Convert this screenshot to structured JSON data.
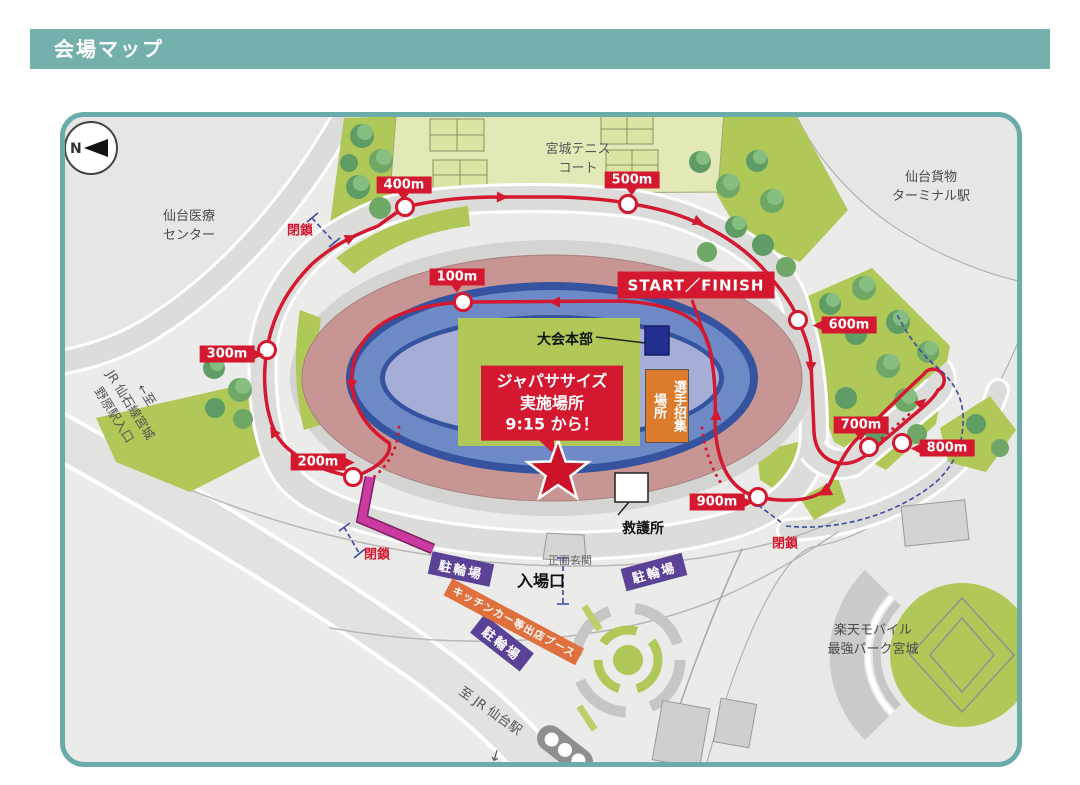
{
  "header": {
    "title": "会場マップ"
  },
  "compass": {
    "label": "N"
  },
  "places": {
    "medical": "仙台医療\nセンター",
    "tennis": "宮城テニス\nコート",
    "freight": "仙台貨物\nターミナル駅",
    "rakuten": "楽天モバイル\n最強パーク宮城",
    "hq": "大会本部",
    "first_aid": "救護所",
    "entrance_gate": "入場口",
    "main_entrance": "正面玄関",
    "assembly": "選手招集\n場所"
  },
  "event_box": {
    "text": "ジャパササイズ\n実施場所\n9:15 から！"
  },
  "course": {
    "start_finish": "START／FINISH",
    "closure_label": "閉鎖",
    "markers": [
      {
        "label": "100m"
      },
      {
        "label": "200m"
      },
      {
        "label": "300m"
      },
      {
        "label": "400m"
      },
      {
        "label": "500m"
      },
      {
        "label": "600m"
      },
      {
        "label": "700m"
      },
      {
        "label": "800m"
      },
      {
        "label": "900m"
      }
    ]
  },
  "banners": {
    "bike": "駐輪場",
    "kitchen": "キッチンカー等出店ブース"
  },
  "directions": {
    "senseki_line": "←至\nJR 仙石線宮城野原駅入口",
    "sendai_station": "至 JR 仙台駅",
    "sendai_arrow": "↓"
  },
  "colors": {
    "header_teal": "#74b1ac",
    "map_border_teal": "#6aacaa",
    "course_red": "#d31830",
    "track_blue": "#6d89c6",
    "infield_periwinkle": "#a6aed7",
    "stands_pink": "#c79694",
    "field_green": "#b0c857",
    "bike_purple": "#5a4397",
    "kitchen_orange": "#e0703d",
    "closed_magenta": "#cb3aa0",
    "closure_dash_blue": "#3b49a8",
    "hq_navy": "#222f8e",
    "assembly_orange": "#dd7b2d"
  }
}
